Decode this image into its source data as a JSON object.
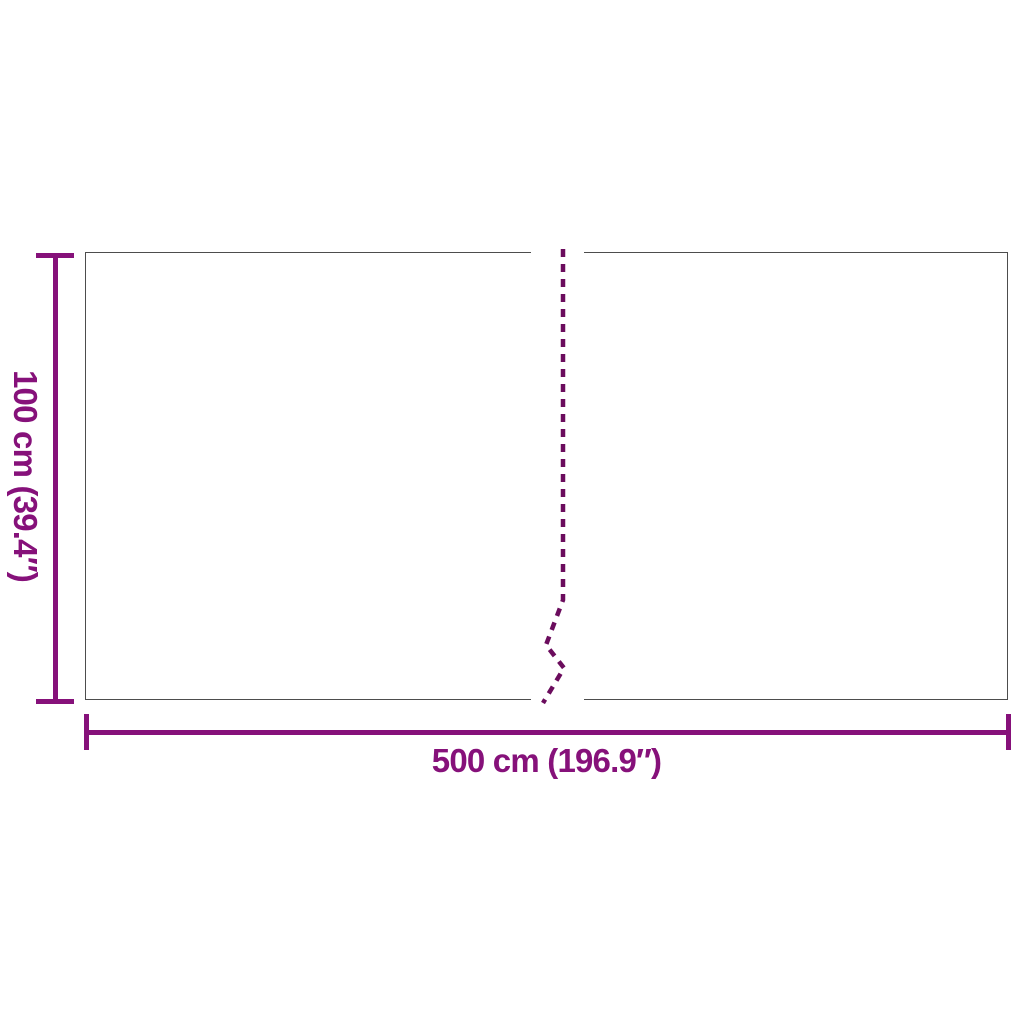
{
  "diagram": {
    "type": "product-dimension-diagram",
    "height_label": "100 cm (39.4″)",
    "width_label": "500 cm (196.9″)",
    "height_value_cm": 100,
    "height_value_inches": 39.4,
    "width_value_cm": 500,
    "width_value_inches": 196.9,
    "colors": {
      "dimension": "#86117A",
      "dash": "#6B0C5D",
      "outline": "#4D4D4D",
      "background": "#FFFFFF"
    }
  }
}
